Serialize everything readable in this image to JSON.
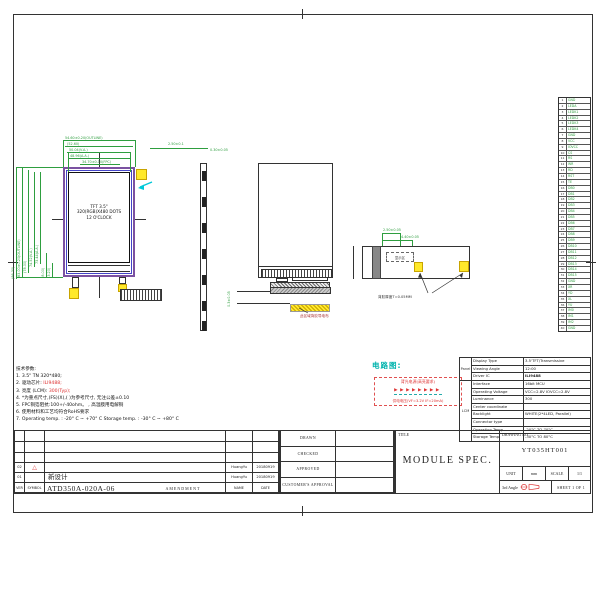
{
  "colors": {
    "dim_green": "#2e9e3f",
    "lcd_border_purple": "#7b51a1",
    "lcd_inner_blue": "#4444c8",
    "highlight_yellow": "#ffe92a",
    "accent_red": "#d33333",
    "circuit_teal": "#00b3ad",
    "line_black": "#333333"
  },
  "main_view": {
    "line1": "TFT 3.5\"",
    "line2": "320(RGB)X480 DOTS",
    "line3": "12 O'CLOCK"
  },
  "dims_top": [
    {
      "label": "54.60±0.20(OUTLINE)",
      "x": 63,
      "y": 140,
      "w": 72
    },
    {
      "label": "(52.60)",
      "x": 65,
      "y": 146,
      "w": 68
    },
    {
      "label": "50.04(V.A.)",
      "x": 67,
      "y": 152,
      "w": 64
    },
    {
      "label": "48.96(A.A.)",
      "x": 68,
      "y": 158,
      "w": 62
    },
    {
      "label": "34.70±0.10(FPC)",
      "x": 80,
      "y": 164,
      "w": 40
    }
  ],
  "dims_left": [
    {
      "label": "(86.30)",
      "x": 16,
      "y": 167,
      "h": 112
    },
    {
      "label": "83.00±0.20(OUTLINE)",
      "x": 22,
      "y": 167,
      "h": 110
    },
    {
      "label": "(78.00)",
      "x": 28,
      "y": 170,
      "h": 103
    },
    {
      "label": "74.52(V.A.)",
      "x": 34,
      "y": 172,
      "h": 95
    },
    {
      "label": "73.44(A.A.)",
      "x": 40,
      "y": 172,
      "h": 92
    },
    {
      "label": "(8.00)",
      "x": 46,
      "y": 253,
      "h": 25
    },
    {
      "label": "(3.20)",
      "x": 52,
      "y": 263,
      "h": 15
    }
  ],
  "dims_side": [
    {
      "label": "2.50±0.1",
      "x": 168,
      "y": 142
    },
    {
      "label": "0.30±0.05",
      "x": 210,
      "y": 148
    }
  ],
  "back_view": {
    "display_label": "显示区",
    "note": "背胶厚度T=0.05MM",
    "dim1": "2.50±0.05",
    "dim2": "4.40±0.05"
  },
  "fpc": {
    "label": "此区域背胶导电布",
    "dim": "0.3±0.05"
  },
  "circuit": {
    "title": "电路图:",
    "line1": "背光电源(高亮要求)",
    "leds": "▶▶▶▶▶▶▶▶",
    "line2": "供电电压(VF=3.2V IF=20mA)"
  },
  "pin_table": {
    "pins": [
      {
        "n": "1",
        "name": "GND"
      },
      {
        "n": "2",
        "name": "LEDA"
      },
      {
        "n": "3",
        "name": "LEDK1"
      },
      {
        "n": "4",
        "name": "LEDK2"
      },
      {
        "n": "5",
        "name": "LEDK3"
      },
      {
        "n": "6",
        "name": "LEDK4"
      },
      {
        "n": "7",
        "name": "GND"
      },
      {
        "n": "8",
        "name": "VCC"
      },
      {
        "n": "9",
        "name": "IOVCC"
      },
      {
        "n": "10",
        "name": "CS"
      },
      {
        "n": "11",
        "name": "RS"
      },
      {
        "n": "12",
        "name": "WR"
      },
      {
        "n": "13",
        "name": "RD"
      },
      {
        "n": "14",
        "name": "RST"
      },
      {
        "n": "15",
        "name": "TE"
      },
      {
        "n": "16",
        "name": "DB0"
      },
      {
        "n": "17",
        "name": "DB1"
      },
      {
        "n": "18",
        "name": "DB2"
      },
      {
        "n": "19",
        "name": "DB3"
      },
      {
        "n": "20",
        "name": "DB4"
      },
      {
        "n": "21",
        "name": "DB5"
      },
      {
        "n": "22",
        "name": "DB6"
      },
      {
        "n": "23",
        "name": "DB7"
      },
      {
        "n": "24",
        "name": "DB8"
      },
      {
        "n": "25",
        "name": "DB9"
      },
      {
        "n": "26",
        "name": "DB10"
      },
      {
        "n": "27",
        "name": "DB11"
      },
      {
        "n": "28",
        "name": "DB12"
      },
      {
        "n": "29",
        "name": "DB13"
      },
      {
        "n": "30",
        "name": "DB14"
      },
      {
        "n": "31",
        "name": "DB15"
      },
      {
        "n": "32",
        "name": "GND"
      },
      {
        "n": "33",
        "name": "XR"
      },
      {
        "n": "34",
        "name": "YD"
      },
      {
        "n": "35",
        "name": "XL"
      },
      {
        "n": "36",
        "name": "YU"
      },
      {
        "n": "37",
        "name": "IM0"
      },
      {
        "n": "38",
        "name": "IM1"
      },
      {
        "n": "39",
        "name": "IM2"
      },
      {
        "n": "40",
        "name": "GND"
      }
    ]
  },
  "notes": {
    "lines": [
      [
        {
          "t": "技术参数:"
        }
      ],
      [
        {
          "t": "1. 3.5\"  TN 320*480;"
        }
      ],
      [
        {
          "t": "2. 驱动芯片: "
        },
        {
          "t": "ILI9488;",
          "r": 1
        }
      ],
      [
        {
          "t": "3. 亮度 (LCM): "
        },
        {
          "t": "300(Typ);",
          "r": 1
        }
      ],
      [
        {
          "t": "4. *为重点尺寸,(FS)(X),( )为参考尺寸, 无注公差±0.10"
        }
      ],
      [
        {
          "t": "5. FPC铜箔阻抗:100+/-40ohm。 , 高温膜用电解铜"
        }
      ],
      [
        {
          "t": "6. 使用材料和工艺均符合RoHS要求"
        }
      ],
      [
        {
          "t": "7. Operating temp. : -20° C ~ +70° C  Storage temp. : -30° C ~ +80° C"
        }
      ]
    ]
  },
  "spec_table": {
    "groups": [
      {
        "label": "Panel",
        "rows": 3
      },
      {
        "label": "LCM",
        "rows": 8
      }
    ],
    "rows": [
      {
        "label": "Display Type",
        "value": "3.5'TFT/Transmissive"
      },
      {
        "label": "Viewing Angle",
        "value": "12:00"
      },
      {
        "label": "Driver IC",
        "value": "ILI9488",
        "b": 1
      },
      {
        "label": "Interface",
        "value": "16bit MCU"
      },
      {
        "label": "Operating Voltage",
        "value": "VCC=2.8V IOVCC=2.8V"
      },
      {
        "label": "Luminance",
        "value": "300"
      },
      {
        "label": "Center coordinate",
        "value": ""
      },
      {
        "label": "Backlight",
        "value": "WHITE(2*4LED, Parallel)"
      },
      {
        "label": "Connector type",
        "value": ""
      },
      {
        "label": "Operation Temp.",
        "value": "-20°C TO 70°C"
      },
      {
        "label": "Storage Temp.",
        "value": "-30°C TO 80°C"
      }
    ]
  },
  "title_block": {
    "title_label": "TITLE",
    "title": "MODULE SPEC.",
    "drawing_no_label": "DRAWING NO.",
    "drawing_no": "YT035HT001",
    "unit_label": "UNIT",
    "unit_value": "mm",
    "scale_label": "SCALE",
    "scale_value": "1/1",
    "angle_label": "3rd Angle",
    "sheet": "SHEET 1 OF 1"
  },
  "approvals": {
    "labels": [
      "DRAWN",
      "CHECKED",
      "APPROVED",
      "CUSTOMER'S APPROVAL"
    ]
  },
  "revision": {
    "rows": [
      [
        "",
        "",
        "",
        "",
        ""
      ],
      [
        "",
        "",
        "",
        "",
        ""
      ],
      [
        "",
        "",
        "",
        "",
        ""
      ],
      [
        "02",
        "△2",
        "",
        "HuangYu",
        "20180919"
      ],
      [
        "01",
        "",
        "新设计",
        "HuangYu",
        "20180919"
      ],
      [
        "VER",
        "SYMBOL",
        "ATD350A-020A-06|AMENDMENT",
        "NAME",
        "DATE"
      ]
    ]
  }
}
